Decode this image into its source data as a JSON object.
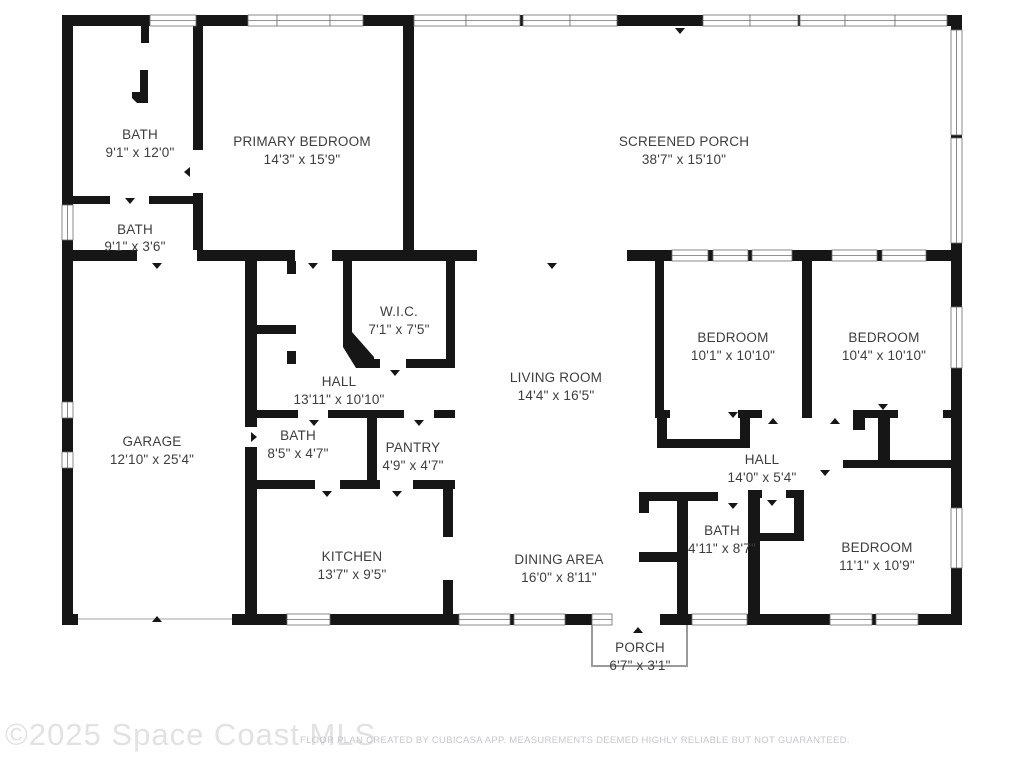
{
  "rooms": [
    {
      "name": "BATH",
      "dims": "9'1\" x 12'0\""
    },
    {
      "name": "PRIMARY BEDROOM",
      "dims": "14'3\" x 15'9\""
    },
    {
      "name": "SCREENED PORCH",
      "dims": "38'7\" x 15'10\""
    },
    {
      "name": "BATH",
      "dims": "9'1\" x 3'6\""
    },
    {
      "name": "W.I.C.",
      "dims": "7'1\" x 7'5\""
    },
    {
      "name": "HALL",
      "dims": "13'11\" x 10'10\""
    },
    {
      "name": "LIVING ROOM",
      "dims": "14'4\" x 16'5\""
    },
    {
      "name": "BEDROOM",
      "dims": "10'1\" x 10'10\""
    },
    {
      "name": "BEDROOM",
      "dims": "10'4\" x 10'10\""
    },
    {
      "name": "GARAGE",
      "dims": "12'10\" x 25'4\""
    },
    {
      "name": "BATH",
      "dims": "8'5\" x 4'7\""
    },
    {
      "name": "PANTRY",
      "dims": "4'9\" x 4'7\""
    },
    {
      "name": "HALL",
      "dims": "14'0\" x 5'4\""
    },
    {
      "name": "KITCHEN",
      "dims": "13'7\" x 9'5\""
    },
    {
      "name": "DINING AREA",
      "dims": "16'0\" x 8'11\""
    },
    {
      "name": "BATH",
      "dims": "4'11\" x 8'7\""
    },
    {
      "name": "BEDROOM",
      "dims": "11'1\" x 10'9\""
    },
    {
      "name": "PORCH",
      "dims": "6'7\" x 3'1\""
    }
  ],
  "watermark": "©2025 Space Coast MLS",
  "footer": "FLOOR PLAN CREATED BY CUBICASA APP. MEASUREMENTS DEEMED HIGHLY RELIABLE BUT NOT GUARANTEED.",
  "colors": {
    "wall": "#161616",
    "label": "#3d3d3d",
    "window_frame": "#6e6e6e",
    "watermark": "#e2e2e2",
    "footer": "#c7c7cc",
    "background": "#ffffff"
  }
}
